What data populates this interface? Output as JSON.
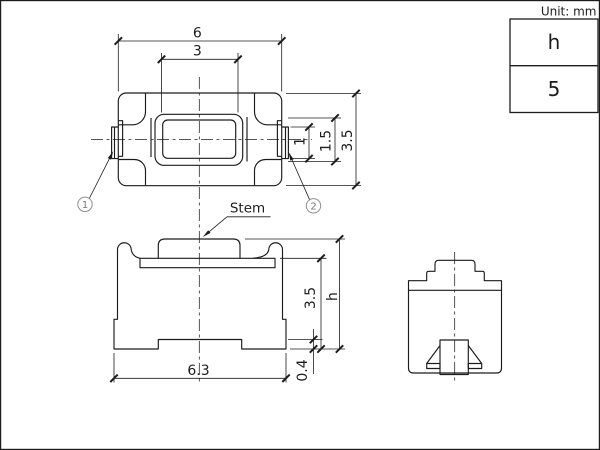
{
  "unit_label": "Unit: mm",
  "spec_table": {
    "parameter": "h",
    "value": "5"
  },
  "stem_label": "Stem",
  "callouts": {
    "one": "1",
    "two": "2"
  },
  "dimensions": {
    "top_view": {
      "overall_width": "6",
      "stem_width": "3",
      "terminal_height": "1",
      "stem_depth": "1.5",
      "overall_depth": "3.5"
    },
    "front_view": {
      "body_height": "3.5",
      "overall_height": "h",
      "bottom_width": "6.3",
      "terminal_offset": "0.4"
    }
  },
  "colors": {
    "line": "#1c1c1c",
    "callout": "#8f8f8f",
    "background": "#ffffff"
  }
}
